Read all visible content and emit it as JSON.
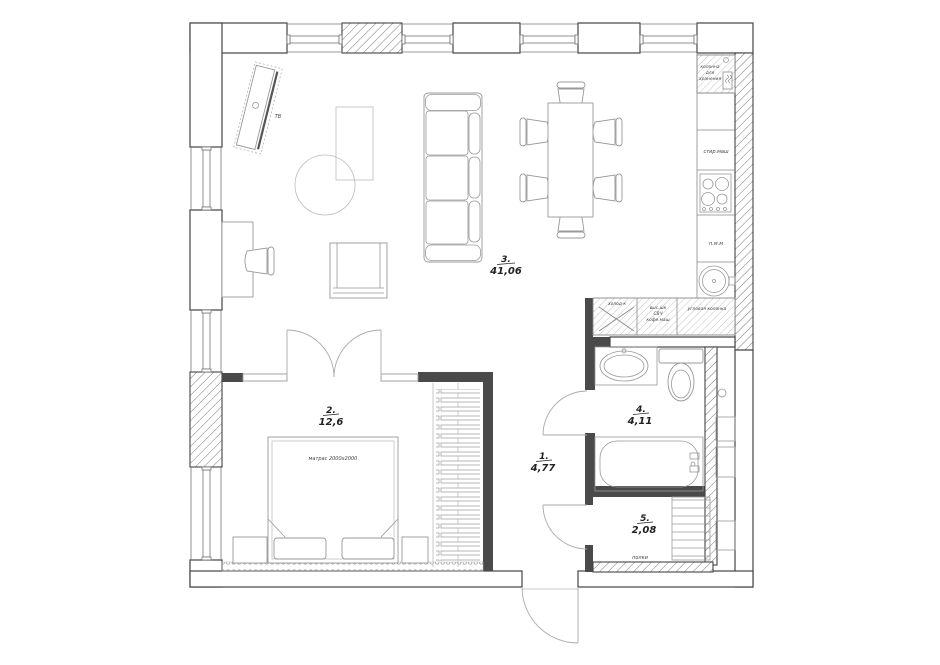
{
  "plan": {
    "rooms": [
      {
        "number": "1.",
        "area": "4,77"
      },
      {
        "number": "2.",
        "area": "12,6"
      },
      {
        "number": "3.",
        "area": "41,06"
      },
      {
        "number": "4.",
        "area": "4,11"
      },
      {
        "number": "5.",
        "area": "2,08"
      }
    ],
    "labels": {
      "tv": "ТВ",
      "mattress": "матрас 2000x2000",
      "shelves": "полки",
      "fridge": "холод-к",
      "tall_cabinet": "выс.шк",
      "microwave": "СВЧ",
      "coffee_machine": "кофе.маш",
      "corner_unit": "угловая колонка",
      "storage_line1": "колонна",
      "storage_line2": "для",
      "storage_line3": "хранения",
      "washer": "стир.маш",
      "dishwasher": "п.м.м"
    },
    "colors": {
      "wall_dark": "#4a4a4a",
      "line": "#999999",
      "background": "#ffffff"
    }
  }
}
